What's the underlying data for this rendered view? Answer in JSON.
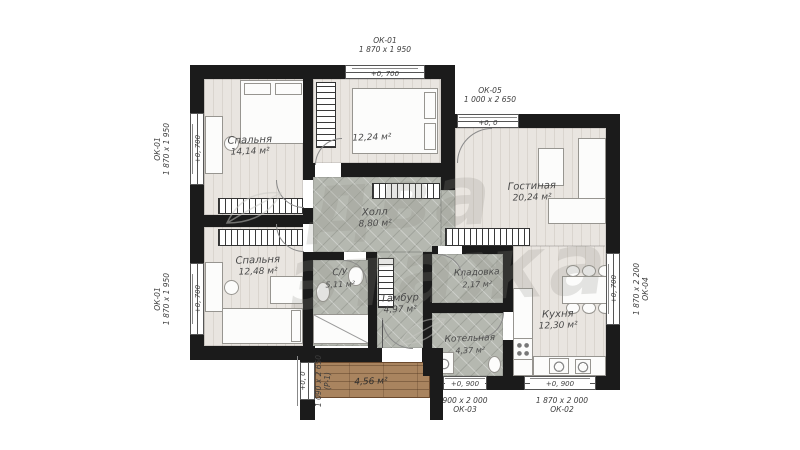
{
  "watermark": {
    "line1": "два",
    "line2": "этажа"
  },
  "rooms": [
    {
      "id": "bedroom-1",
      "name": "Спальня",
      "area": "14,14 м²"
    },
    {
      "id": "bedroom-2",
      "name": "",
      "area": "12,24 м²"
    },
    {
      "id": "living",
      "name": "Гостиная",
      "area": "20,24 м²"
    },
    {
      "id": "hall",
      "name": "Холл",
      "area": "8,80 м²"
    },
    {
      "id": "bedroom-3",
      "name": "Спальня",
      "area": "12,48 м²"
    },
    {
      "id": "wc",
      "name": "С/У",
      "area": "5,11 м²"
    },
    {
      "id": "tambour",
      "name": "Тамбур",
      "area": "4,97 м²"
    },
    {
      "id": "storage",
      "name": "Кладовка",
      "area": "2,17 м²"
    },
    {
      "id": "boiler",
      "name": "Котельная",
      "area": "4,37 м²"
    },
    {
      "id": "kitchen",
      "name": "Кухня",
      "area": "12,30 м²"
    },
    {
      "id": "terrace",
      "name": "",
      "area": "4,56 м²"
    }
  ],
  "openings": [
    {
      "id": "ok01-left-top",
      "code": "ОК-01",
      "size": "1 870 х 1 950",
      "level": "+0, 700"
    },
    {
      "id": "ok01-left-bottom",
      "code": "ОК-01",
      "size": "1 870 х 1 950",
      "level": "+0, 700"
    },
    {
      "id": "ok01-top",
      "code": "ОК-01",
      "size": "1 870 х 1 950",
      "level": "+0, 700"
    },
    {
      "id": "ok05-top",
      "code": "ОК-05",
      "size": "1 000 х 2 650",
      "level": "+0, 0"
    },
    {
      "id": "ok04-right",
      "code": "ОК-04",
      "size": "1 870 х 2 200",
      "level": "+0, 700"
    },
    {
      "id": "ok02-bottom",
      "code": "ОК-02",
      "size": "1 870 х 2 000",
      "level": "+0, 900"
    },
    {
      "id": "ok03-bottom",
      "code": "ОК-03",
      "size": "900 х 2 000",
      "level": "+0, 900"
    },
    {
      "id": "p1-door",
      "code": "(Р-1)",
      "size": "1 090 х 2 650",
      "level": "+0, 0"
    }
  ],
  "colors": {
    "wall": "#1b1b1b",
    "wood_floor": "#e9e5e0",
    "tile_floor": "#b5b8b0",
    "deck_wood": "#a9845f",
    "label_text": "#4a4a4a",
    "watermark": "#8c8c86"
  }
}
